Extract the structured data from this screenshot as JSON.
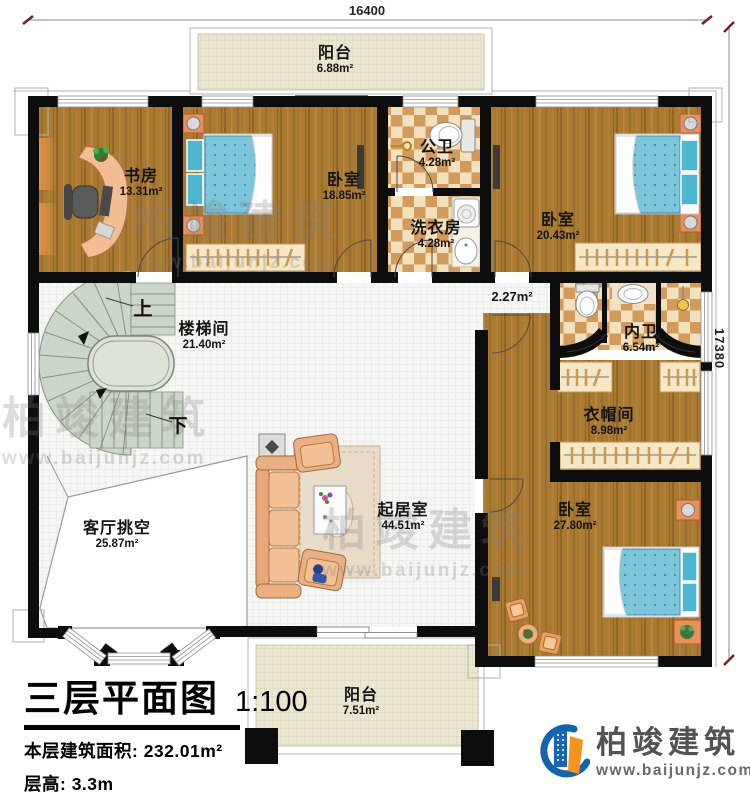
{
  "dimensions": {
    "top": "16400",
    "right": "17380"
  },
  "rooms": [
    {
      "id": "balcony-top",
      "name": "阳台",
      "area": "6.88m²"
    },
    {
      "id": "study",
      "name": "书房",
      "area": "13.31m²"
    },
    {
      "id": "bedroom-top",
      "name": "卧室",
      "area": "18.85m²"
    },
    {
      "id": "public-bath",
      "name": "公卫",
      "area": "4.28m²"
    },
    {
      "id": "laundry",
      "name": "洗衣房",
      "area": "4.28m²"
    },
    {
      "id": "bedroom-right",
      "name": "卧室",
      "area": "20.43m²"
    },
    {
      "id": "stairwell",
      "name": "楼梯间",
      "area": "21.40m²"
    },
    {
      "id": "hallway",
      "name": "",
      "area": "2.27m²"
    },
    {
      "id": "master-bath",
      "name": "内卫",
      "area": "6.54m²"
    },
    {
      "id": "cloakroom",
      "name": "衣帽间",
      "area": "8.98m²"
    },
    {
      "id": "living-void",
      "name": "客厅挑空",
      "area": "25.87m²"
    },
    {
      "id": "living-room",
      "name": "起居室",
      "area": "44.51m²"
    },
    {
      "id": "bedroom-master",
      "name": "卧室",
      "area": "27.80m²"
    },
    {
      "id": "balcony-bottom",
      "name": "阳台",
      "area": "7.51m²"
    }
  ],
  "stairs": {
    "up": "上",
    "down": "下"
  },
  "title_block": {
    "title": "三层平面图",
    "scale": "1:100",
    "area_label": "本层建筑面积:",
    "area_value": "232.01m²",
    "floor_height_label": "层高:",
    "floor_height_value": "3.3m"
  },
  "brand": {
    "name": "柏竣建筑",
    "website": "www.baijunjz.com"
  },
  "watermark": {
    "name": "柏竣建筑",
    "website": "www.baijunjz.com"
  },
  "colors": {
    "wall": "#0d0d0d",
    "wood_floor": "#aa7a33",
    "checker_light": "#f3e0bd",
    "checker_dark": "#d29b5c",
    "balcony_floor": "#eae6cf",
    "hall_tile": "#f6f6f4",
    "stair_fill": "#ccd6c8",
    "bed_blue": "#7cc5da",
    "sofa_peach": "#f0b88c",
    "brand_blue": "#1464ad",
    "brand_orange": "#f5941d"
  }
}
